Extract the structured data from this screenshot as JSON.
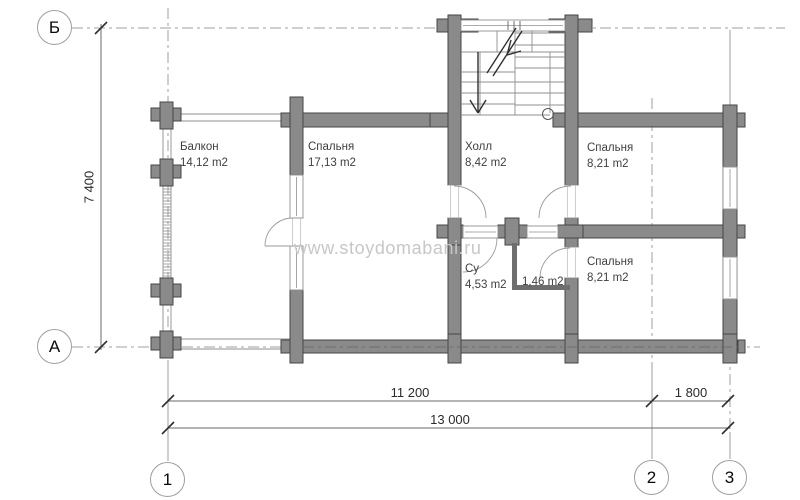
{
  "watermark": "www.stoydomabani.ru",
  "axis_markers": [
    {
      "label": "Б",
      "cx": 55,
      "cy": 28
    },
    {
      "label": "А",
      "cx": 55,
      "cy": 347
    },
    {
      "label": "1",
      "cx": 168,
      "cy": 480
    },
    {
      "label": "2",
      "cx": 652,
      "cy": 478
    },
    {
      "label": "3",
      "cx": 730,
      "cy": 478
    }
  ],
  "rooms": [
    {
      "name": "Балкон",
      "area": "14,12 m2",
      "x": 180,
      "y": 140
    },
    {
      "name": "Спальня",
      "area": "17,13 m2",
      "x": 308,
      "y": 140
    },
    {
      "name": "Холл",
      "area": "8,42 m2",
      "x": 465,
      "y": 140
    },
    {
      "name": "Спальня",
      "area": "8,21 m2",
      "x": 587,
      "y": 141
    },
    {
      "name": "Спальня",
      "area": "8,21 m2",
      "x": 587,
      "y": 255
    },
    {
      "name": "Су",
      "area": "4,53 m2",
      "x": 465,
      "y": 262
    },
    {
      "name": "",
      "area": "1,46 m2",
      "x": 522,
      "y": 275
    }
  ],
  "dimensions": {
    "vertical": "7 400",
    "h_segment_1": "11 200",
    "h_segment_2": "1 800",
    "h_total": "13 000"
  },
  "colors": {
    "wall": "#8a8a8a",
    "wall_outline": "#454545",
    "thin_wall": "#6e6e6e",
    "line": "#8f8f8f",
    "grid": "#9f9f9f",
    "grid_on_wall": "#6f6f6f",
    "dim_line": "#6a6a6a",
    "tick": "#2f2f2f",
    "door": "#9a9a9a"
  },
  "geometry": {
    "grid_lines": [
      {
        "d": [
          72,
          28,
          785,
          28
        ],
        "dash": true
      },
      {
        "d": [
          72,
          347,
          760,
          347
        ],
        "dash": true
      },
      {
        "d": [
          168,
          8,
          168,
          360
        ],
        "dash": true
      },
      {
        "d": [
          652,
          98,
          652,
          364
        ],
        "dash": true
      },
      {
        "d": [
          730,
          352,
          730,
          432
        ],
        "dash": true
      },
      {
        "d": [
          168,
          360,
          168,
          461
        ],
        "dash": false
      },
      {
        "d": [
          652,
          364,
          652,
          459
        ],
        "dash": false
      },
      {
        "d": [
          730,
          432,
          730,
          459
        ],
        "dash": false
      },
      {
        "d": [
          730,
          30,
          730,
          105
        ],
        "dash": false
      }
    ],
    "grid_overlay_dash": [
      303,
      347,
      738,
      347
    ],
    "rail_lines": [
      [
        172,
        114,
        291,
        114
      ],
      [
        172,
        121,
        291,
        121
      ],
      [
        172,
        339,
        291,
        339
      ],
      [
        172,
        349,
        291,
        349
      ],
      [
        163,
        112,
        163,
        350
      ],
      [
        171,
        112,
        171,
        350
      ]
    ],
    "hatch_band": {
      "x1": 163,
      "x2": 171,
      "y1": 186,
      "y2": 279,
      "step": 3
    },
    "walls": [
      [
        151,
        108,
        30,
        13
      ],
      [
        160,
        102,
        13,
        27
      ],
      [
        151,
        165,
        30,
        13
      ],
      [
        160,
        159,
        13,
        27
      ],
      [
        151,
        284,
        30,
        13
      ],
      [
        160,
        278,
        13,
        27
      ],
      [
        151,
        337,
        30,
        13
      ],
      [
        160,
        331,
        13,
        27
      ],
      [
        290,
        97,
        13,
        78
      ],
      [
        290,
        290,
        13,
        73
      ],
      [
        281,
        113,
        9,
        14
      ],
      [
        281,
        340,
        9,
        13
      ],
      [
        303,
        113,
        146,
        14
      ],
      [
        448,
        15,
        13,
        170
      ],
      [
        448,
        218,
        13,
        124
      ],
      [
        565,
        15,
        13,
        170
      ],
      [
        565,
        218,
        13,
        29
      ],
      [
        565,
        278,
        13,
        64
      ],
      [
        437,
        19,
        11,
        13
      ],
      [
        461,
        19,
        17,
        13
      ],
      [
        549,
        19,
        16,
        13
      ],
      [
        578,
        19,
        14,
        13
      ],
      [
        430,
        113,
        18,
        14
      ],
      [
        553,
        113,
        12,
        14
      ],
      [
        578,
        113,
        145,
        14
      ],
      [
        723,
        105,
        14,
        250
      ],
      [
        737,
        113,
        8,
        14
      ],
      [
        737,
        225,
        8,
        13
      ],
      [
        737,
        340,
        8,
        13
      ],
      [
        437,
        225,
        26,
        13
      ],
      [
        448,
        218,
        13,
        27
      ],
      [
        498,
        225,
        29,
        13
      ],
      [
        505,
        218,
        14,
        27
      ],
      [
        558,
        225,
        25,
        13
      ],
      [
        583,
        225,
        140,
        13
      ],
      [
        303,
        340,
        435,
        13
      ],
      [
        448,
        334,
        13,
        29
      ],
      [
        565,
        334,
        13,
        29
      ],
      [
        723,
        334,
        14,
        29
      ]
    ],
    "thin_walls": [
      [
        512,
        243,
        5,
        47
      ],
      [
        512,
        285,
        58,
        5
      ]
    ],
    "windows": [
      {
        "r": [
          290,
          175,
          13,
          43
        ],
        "o": "v"
      },
      {
        "r": [
          290,
          246,
          13,
          44
        ],
        "o": "v"
      },
      {
        "r": [
          461,
          20,
          104,
          11
        ],
        "o": "h",
        "mullions": [
          508,
          514,
          520
        ]
      },
      {
        "r": [
          723,
          167,
          14,
          42
        ],
        "o": "v"
      },
      {
        "r": [
          723,
          257,
          14,
          42
        ],
        "o": "v"
      },
      {
        "r": [
          463,
          226,
          35,
          12
        ],
        "o": "h"
      },
      {
        "r": [
          527,
          226,
          31,
          12
        ],
        "o": "h"
      }
    ],
    "openings": [
      {
        "r": [
          290,
          218,
          13,
          28
        ],
        "o": "v"
      },
      {
        "r": [
          448,
          185,
          13,
          33
        ],
        "o": "v"
      },
      {
        "r": [
          565,
          185,
          13,
          33
        ],
        "o": "v"
      },
      {
        "r": [
          565,
          247,
          13,
          31
        ],
        "o": "v"
      }
    ],
    "door_arcs": [
      "M 265,246 A 28 28 0 0 1 293,218",
      "M 454,186 A 32 32 0 0 1 486,218",
      "M 571,186 A 32 32 0 0 0 539,218",
      "M 497,238 A 34 34 0 0 1 463,272",
      "M 540,278 A 30 30 0 0 1 570,248"
    ],
    "door_leaves": [
      [
        265,
        246,
        293,
        246
      ]
    ],
    "stair_lines": [
      [
        461,
        52,
        565,
        52
      ],
      [
        461,
        72,
        515,
        72
      ],
      [
        461,
        82,
        515,
        82
      ],
      [
        461,
        93,
        515,
        93
      ],
      [
        461,
        104,
        515,
        104
      ],
      [
        461,
        115,
        550,
        115
      ],
      [
        515,
        33,
        565,
        33
      ],
      [
        515,
        45,
        565,
        45
      ],
      [
        515,
        57,
        565,
        57
      ],
      [
        515,
        68,
        565,
        68
      ],
      [
        515,
        82,
        565,
        82
      ],
      [
        515,
        93,
        565,
        93
      ],
      [
        515,
        105,
        565,
        105
      ],
      [
        497,
        31,
        497,
        52
      ],
      [
        532,
        31,
        532,
        52
      ],
      [
        515,
        31,
        515,
        115
      ],
      [
        480,
        52,
        480,
        115
      ],
      [
        550,
        52,
        550,
        113
      ]
    ],
    "stair_arrow": [
      [
        478,
        52,
        478,
        112
      ],
      [
        470,
        100,
        478,
        113
      ],
      [
        486,
        100,
        478,
        113
      ],
      [
        487,
        73,
        516,
        28
      ],
      [
        493,
        76,
        522,
        31
      ],
      [
        507,
        55,
        521,
        51
      ],
      [
        507,
        55,
        511,
        40
      ]
    ],
    "stair_circle": {
      "cx": 548,
      "cy": 114,
      "r": 5.5
    },
    "dim_lines": [
      [
        101,
        24,
        101,
        350
      ],
      [
        168,
        401,
        730,
        401
      ],
      [
        168,
        428,
        730,
        428
      ]
    ],
    "dim_ticks": [
      [
        101,
        28
      ],
      [
        101,
        347
      ],
      [
        168,
        401
      ],
      [
        652,
        401
      ],
      [
        728,
        401
      ],
      [
        168,
        428
      ],
      [
        728,
        428
      ]
    ]
  }
}
